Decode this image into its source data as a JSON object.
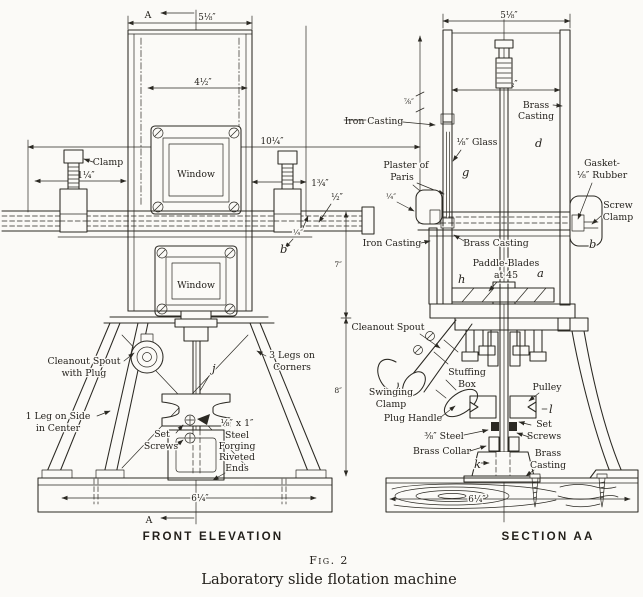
{
  "figure": {
    "fig_label": "Fig. 2",
    "title": "Laboratory slide flotation machine"
  },
  "colors": {
    "ink": "#2b2923",
    "paper": "#fbfaf7"
  },
  "front": {
    "view_title": "FRONT ELEVATION",
    "marker_top": "A",
    "marker_bottom": "A",
    "dim_top_width": "5⅛″",
    "dim_inner_width": "4½″",
    "dim_overall": "10¼″",
    "dim_clamp": "1¼″",
    "dim_right_offset": "1¾″",
    "dim_half": "½″",
    "dim_quarter": "¼″",
    "dim_upper_height": "7″",
    "dim_lower_height": "8″",
    "dim_base": "6¼″",
    "label_clamp": "Clamp",
    "window_upper": "Window",
    "window_lower": "Window",
    "cleanout": [
      "Cleanout Spout",
      "with Plug"
    ],
    "legs3": [
      "3 Legs on",
      "Corners"
    ],
    "leg1": [
      "1 Leg on Side",
      "in Center"
    ],
    "set_screws": [
      "Set",
      "Screws"
    ],
    "forging": [
      "⅛″ x 1″",
      "Steel",
      "Forging",
      "Riveted",
      "Ends"
    ],
    "part_b": "b",
    "part_j": "j"
  },
  "section": {
    "view_title": "SECTION AA",
    "dim_top_width": "5⅛″",
    "dim_inner_width": "4½″",
    "dim_left_height": "⅞″",
    "dim_quarter": "¼″",
    "dim_base": "6¼″",
    "iron_casting_top": "Iron Casting",
    "glass": "⅛″ Glass",
    "plaster": [
      "Plaster of",
      "Paris"
    ],
    "brass_casting_top": [
      "Brass",
      "Casting"
    ],
    "gasket": [
      "Gasket-",
      "⅛″ Rubber"
    ],
    "screw_clamp": [
      "Screw",
      "Clamp"
    ],
    "iron_casting": "Iron Casting",
    "brass_casting": "Brass Casting",
    "paddle": [
      "Paddle-Blades",
      "at 45"
    ],
    "cleanout_spout": "Cleanout Spout",
    "swinging_clamp": [
      "Swinging",
      "Clamp"
    ],
    "stuffing_box": [
      "Stuffing",
      "Box"
    ],
    "plug_handle": "Plug Handle",
    "pulley": "Pulley",
    "set_screws": [
      "Set",
      "Screws"
    ],
    "steel": "⅜″ Steel",
    "brass_collar": "Brass Collar",
    "brass_casting_bottom": [
      "Brass",
      "Casting"
    ],
    "part_a": "a",
    "part_b": "b",
    "part_d": "d",
    "part_g": "g",
    "part_h": "h",
    "part_k": "k",
    "part_l": "l"
  }
}
